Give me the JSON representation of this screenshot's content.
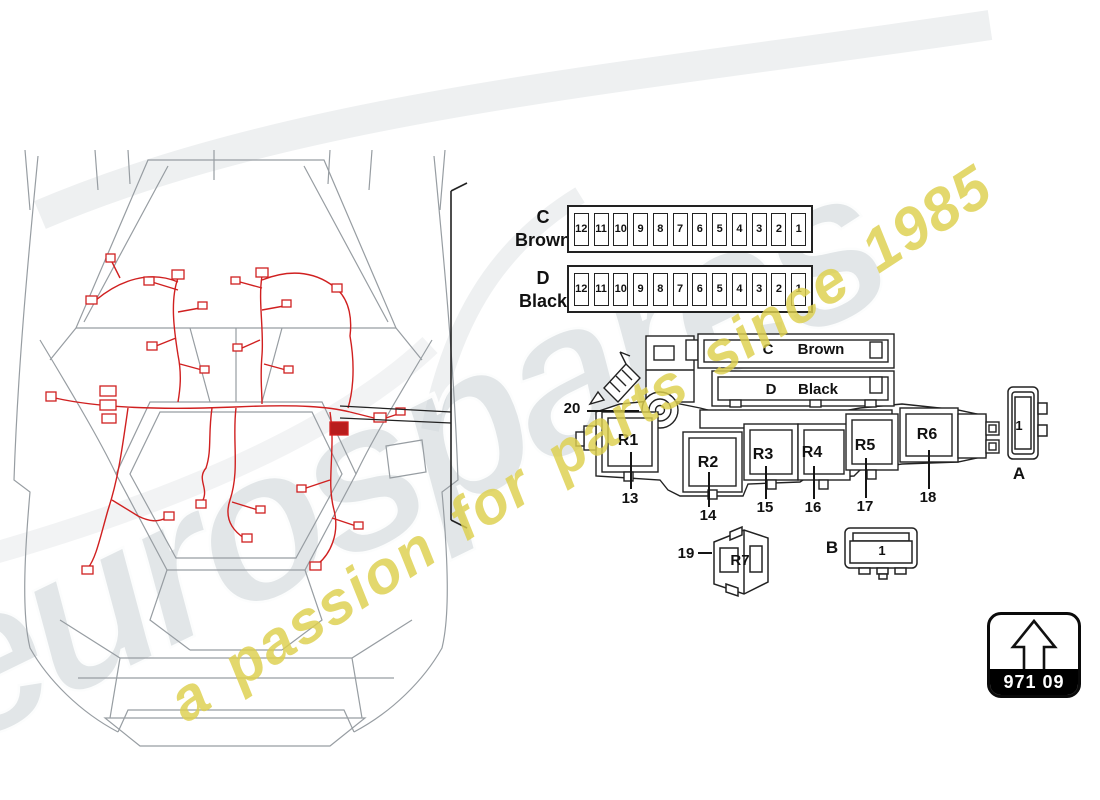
{
  "watermark": {
    "brand": "eurospares",
    "tagline": "a passion for parts since 1985"
  },
  "fuse_rows": [
    {
      "letter": "C",
      "color_name": "Brown",
      "fuses": [
        "12",
        "11",
        "10",
        "9",
        "8",
        "7",
        "6",
        "5",
        "4",
        "3",
        "2",
        "1"
      ]
    },
    {
      "letter": "D",
      "color_name": "Black",
      "fuses": [
        "12",
        "11",
        "10",
        "9",
        "8",
        "7",
        "6",
        "5",
        "4",
        "3",
        "2",
        "1"
      ]
    }
  ],
  "relay_panel": {
    "connector_labels": [
      {
        "letter": "C",
        "color_name": "Brown"
      },
      {
        "letter": "D",
        "color_name": "Black"
      }
    ],
    "relays": [
      {
        "label": "R1",
        "callout": "13"
      },
      {
        "label": "R2",
        "callout": "14"
      },
      {
        "label": "R3",
        "callout": "15"
      },
      {
        "label": "R4",
        "callout": "16"
      },
      {
        "label": "R5",
        "callout": "17"
      },
      {
        "label": "R6",
        "callout": "18"
      }
    ],
    "bracket_callout": "20"
  },
  "extra_relay": {
    "label": "R7",
    "callout": "19"
  },
  "connector_a": {
    "label": "A",
    "slot": "1"
  },
  "connector_b": {
    "label": "B",
    "slot": "1"
  },
  "part_badge": {
    "code": "971 09"
  },
  "colors": {
    "harness": "#d02020",
    "body_lines": "#979da2",
    "ink": "#1a1a1a",
    "tagline": "#ddd04d"
  }
}
